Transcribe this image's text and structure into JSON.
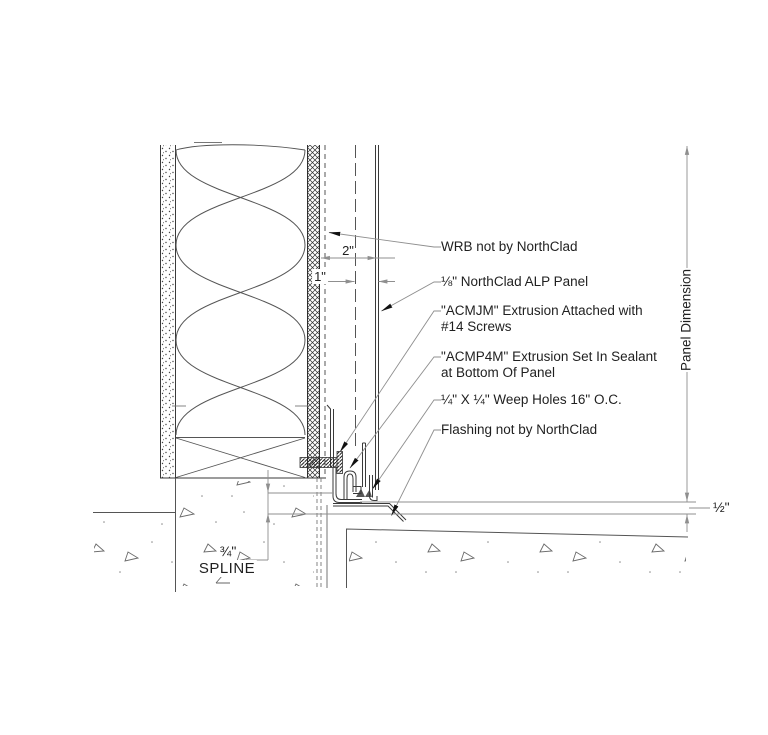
{
  "drawing": {
    "callouts": [
      {
        "id": "wrb",
        "text": "WRB not by NorthClad"
      },
      {
        "id": "panel",
        "text": "⅛\" NorthClad ALP Panel"
      },
      {
        "id": "acmjm",
        "line1": "\"ACMJM\" Extrusion Attached with",
        "line2": "#14 Screws"
      },
      {
        "id": "acmp4m",
        "line1": "\"ACMP4M\" Extrusion Set In Sealant",
        "line2": "at Bottom Of Panel"
      },
      {
        "id": "weep",
        "text": "¼\" X ¼\" Weep Holes 16\" O.C."
      },
      {
        "id": "flashing",
        "text": "Flashing not by NorthClad"
      }
    ],
    "dimensions": {
      "two_inch": "2\"",
      "one_inch": "1\"",
      "half_inch": "½\"",
      "three_quarter": "¾\"",
      "spline": "SPLINE",
      "panel_dimension": "Panel Dimension"
    },
    "colors": {
      "background": "#ffffff",
      "line_dark": "#3a3a3a",
      "line_gray": "#8f8f8f",
      "concrete_gray": "#6a6a6a",
      "arrow_black": "#111111"
    }
  }
}
